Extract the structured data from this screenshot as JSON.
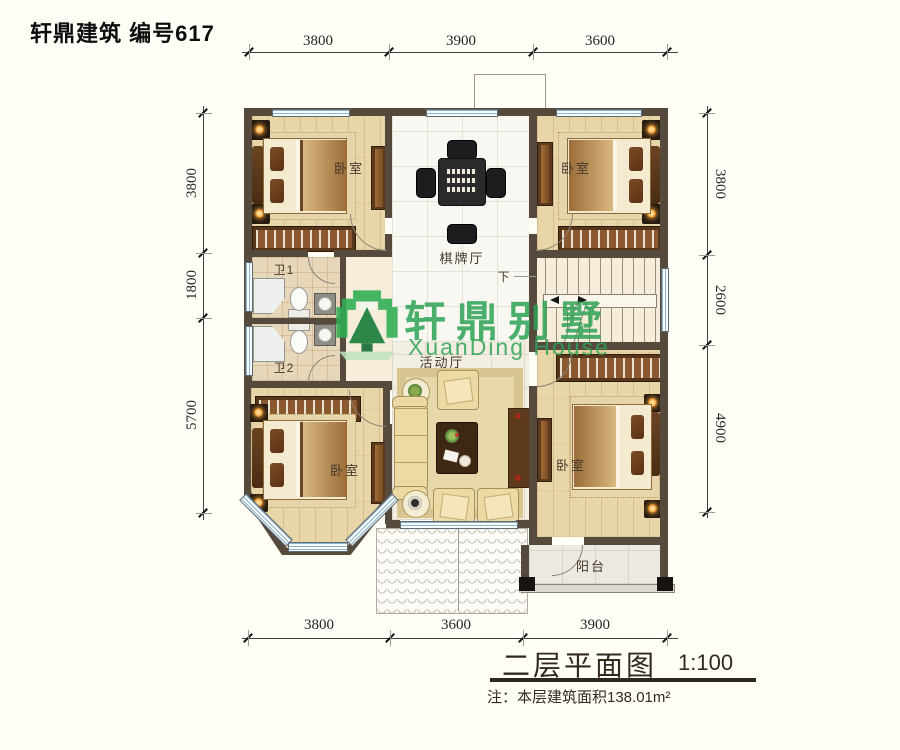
{
  "header": {
    "title": "轩鼎建筑 编号617"
  },
  "plan": {
    "labels": {
      "bedroom": "卧室",
      "game_room": "棋牌厅",
      "bath1": "卫1",
      "bath2": "卫2",
      "living": "活动厅",
      "balcony": "阳台",
      "down": "下"
    },
    "dimensions": {
      "top": [
        "3800",
        "3900",
        "3600"
      ],
      "bottom": [
        "3800",
        "3600",
        "3900"
      ],
      "left": [
        "3800",
        "1800",
        "5700"
      ],
      "right": [
        "3800",
        "2600",
        "4900"
      ]
    }
  },
  "watermark": {
    "brand_cn": "轩鼎别墅",
    "brand_en": "XuanDing House"
  },
  "title_block": {
    "name": "二层平面图",
    "scale": "1:100",
    "note": "注：本层建筑面积138.01m²"
  }
}
